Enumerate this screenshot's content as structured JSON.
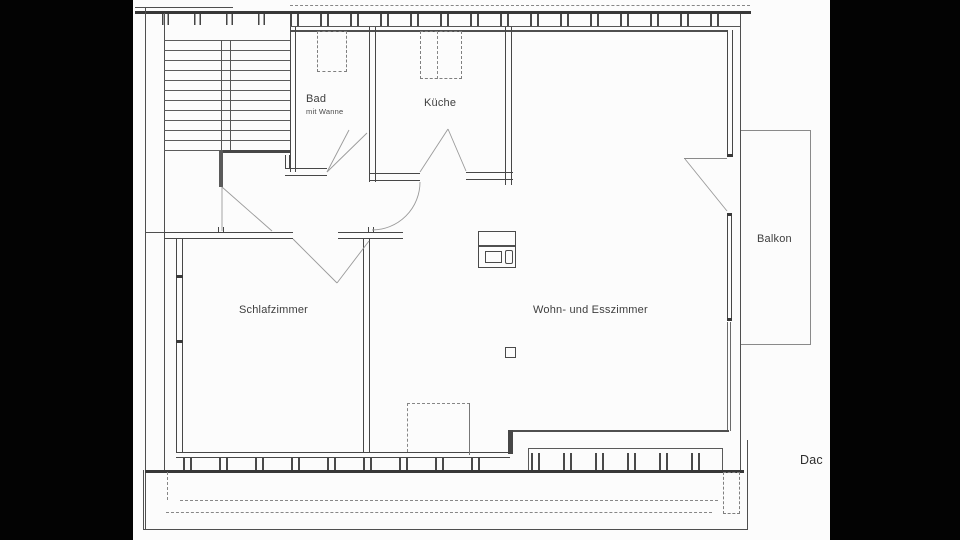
{
  "floorplan": {
    "type": "apartment-floor-plan (attic storey, scanned drawing)",
    "rooms": [
      {
        "id": "bad",
        "label": "Bad",
        "sublabel": "mit Wanne"
      },
      {
        "id": "kueche",
        "label": "Küche"
      },
      {
        "id": "schlafzimmer",
        "label": "Schlafzimmer"
      },
      {
        "id": "wohnzimmer",
        "label": "Wohn- und Esszimmer"
      },
      {
        "id": "balkon",
        "label": "Balkon"
      }
    ],
    "annotations": {
      "dach": "Dac"
    }
  },
  "colors": {
    "letterbox": "#030303",
    "paper": "#fcfcfc",
    "line": "#4f4f4f",
    "line_thick": "#383838",
    "swing_line": "#9a9a9a",
    "text": "#3e3e3e"
  }
}
